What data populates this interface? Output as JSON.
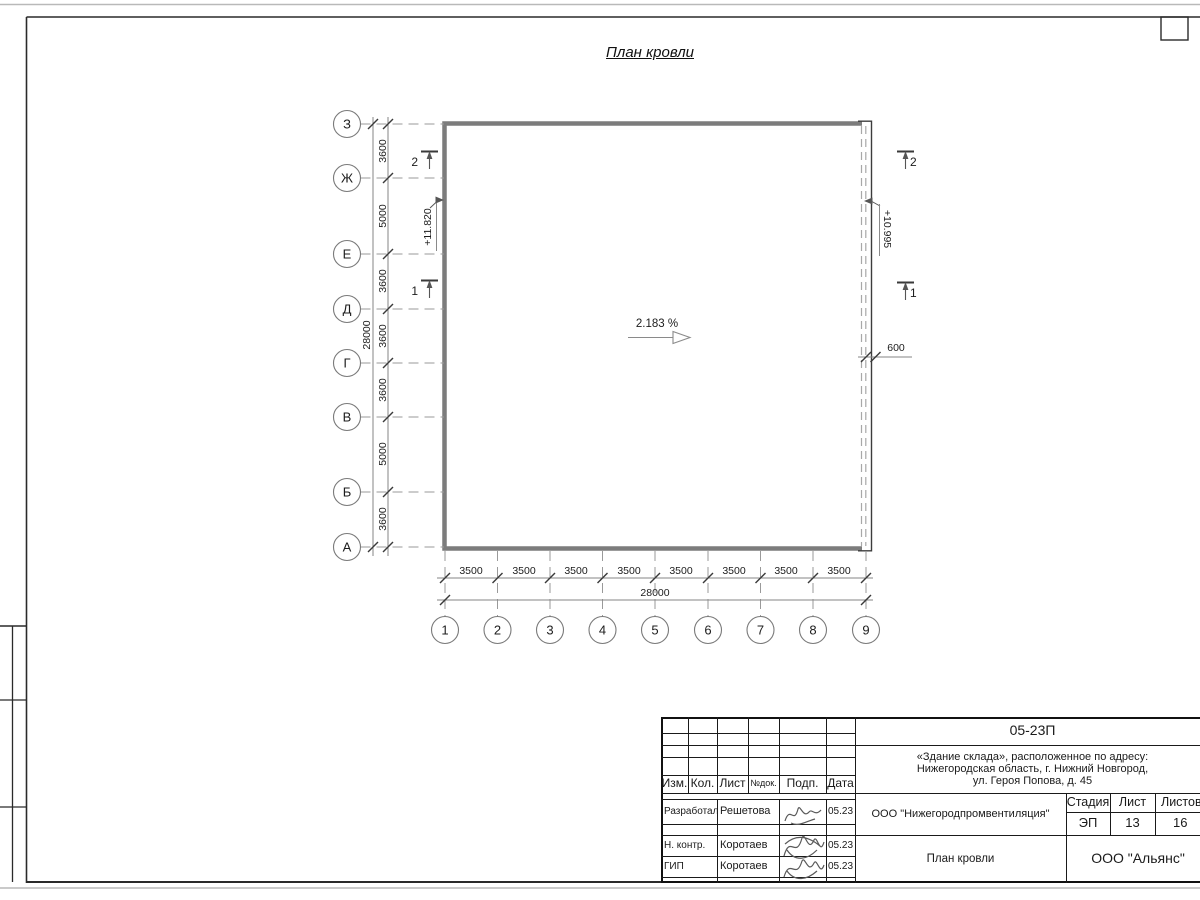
{
  "page": {
    "title": "План кровли"
  },
  "drawing": {
    "slope": "2.183 %",
    "elevation_left": "+11.820",
    "elevation_right": "+10.995",
    "dim_right": "600",
    "section_1": "1",
    "section_2": "2",
    "axes_rows": [
      "З",
      "Ж",
      "Е",
      "Д",
      "Г",
      "В",
      "Б",
      "А"
    ],
    "axes_cols": [
      "1",
      "2",
      "3",
      "4",
      "5",
      "6",
      "7",
      "8",
      "9"
    ],
    "dims_rows": [
      "3600",
      "5000",
      "3600",
      "3600",
      "3600",
      "5000",
      "3600"
    ],
    "dims_rows_total": "28000",
    "dims_cols": [
      "3500",
      "3500",
      "3500",
      "3500",
      "3500",
      "3500",
      "3500",
      "3500"
    ],
    "dims_cols_total": "28000"
  },
  "titleblock": {
    "code": "05-23П",
    "address_line1": "«Здание склада», расположенное по адресу:",
    "address_line2": "Нижегородская область, г. Нижний Новгород,",
    "address_line3": "ул. Героя Попова, д. 45",
    "header_cols": [
      "Изм.",
      "Кол.",
      "Лист",
      "№док.",
      "Подп.",
      "Дата"
    ],
    "rows": [
      {
        "role": "Разработал",
        "name": "Решетова",
        "date": "05.23"
      },
      {
        "role": "Н. контр.",
        "name": "Коротаев",
        "date": "05.23"
      },
      {
        "role": "ГИП",
        "name": "Коротаев",
        "date": "05.23"
      }
    ],
    "company": "ООО \"Нижегородпромвентиляция\"",
    "stage_label": "Стадия",
    "stage": "ЭП",
    "sheet_label": "Лист",
    "sheet": "13",
    "sheets_label": "Листов",
    "sheets": "16",
    "doc_title": "План кровли",
    "org": "ООО \"Альянс\""
  }
}
